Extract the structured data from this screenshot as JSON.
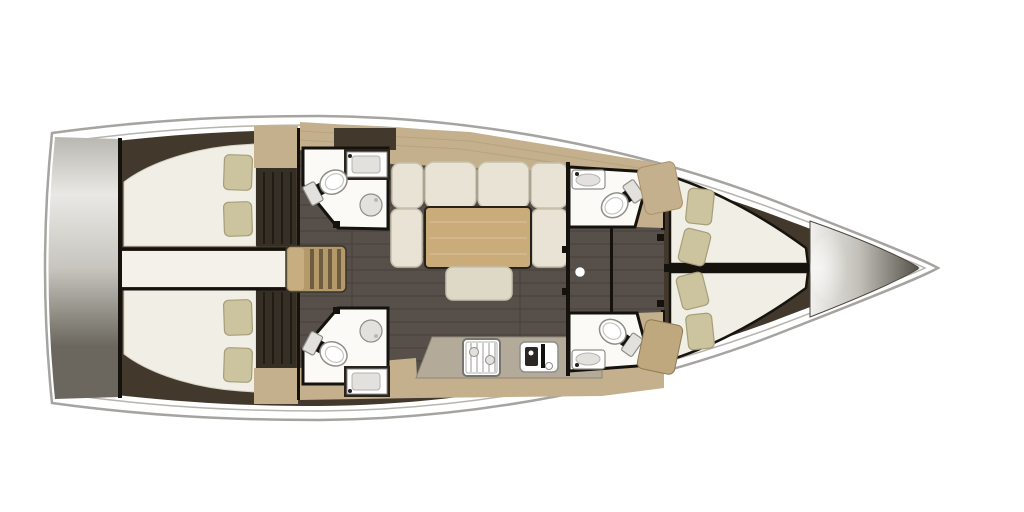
{
  "plan": {
    "description": "Sailing yacht interior floor plan, top-down view, bow to the right",
    "rooms": [
      {
        "id": "swim-platform",
        "type": "transom-platform",
        "fixtures": [
          "platform"
        ]
      },
      {
        "id": "aft-cabin-port",
        "type": "double-berth-cabin",
        "fixtures": [
          "double-berth",
          "pillow",
          "pillow",
          "wardrobe"
        ]
      },
      {
        "id": "aft-cabin-starboard",
        "type": "double-berth-cabin",
        "fixtures": [
          "double-berth",
          "pillow",
          "pillow",
          "wardrobe"
        ]
      },
      {
        "id": "engine-compartment",
        "type": "passage",
        "fixtures": []
      },
      {
        "id": "companionway",
        "type": "entry",
        "fixtures": [
          "steps"
        ]
      },
      {
        "id": "head-aft-port",
        "type": "bathroom",
        "fixtures": [
          "toilet",
          "sink",
          "shower"
        ]
      },
      {
        "id": "head-aft-starboard",
        "type": "bathroom",
        "fixtures": [
          "toilet",
          "sink",
          "shower"
        ]
      },
      {
        "id": "salon",
        "type": "saloon",
        "fixtures": [
          "u-shaped-settee",
          "table",
          "ottoman"
        ]
      },
      {
        "id": "galley",
        "type": "kitchen",
        "fixtures": [
          "stove",
          "double-sink",
          "counter"
        ]
      },
      {
        "id": "head-forward-port",
        "type": "bathroom",
        "fixtures": [
          "toilet",
          "sink"
        ]
      },
      {
        "id": "head-forward-starboard",
        "type": "bathroom",
        "fixtures": [
          "toilet",
          "sink"
        ]
      },
      {
        "id": "mast-post",
        "type": "structure",
        "fixtures": [
          "compression-post"
        ]
      },
      {
        "id": "forward-cabin-port",
        "type": "v-berth",
        "fixtures": [
          "berth",
          "pillow",
          "pillow"
        ]
      },
      {
        "id": "forward-cabin-starboard",
        "type": "v-berth",
        "fixtures": [
          "berth",
          "pillow",
          "pillow"
        ]
      },
      {
        "id": "bow-locker",
        "type": "anchor-locker",
        "fixtures": [
          "locker-cone"
        ]
      }
    ],
    "counts": {
      "cabins": 4,
      "heads": 4,
      "pillows": 8,
      "settee_back_cushions": 4,
      "companionway_steps": 4
    }
  },
  "colors": {
    "hull_fill": "#ffffff",
    "hull_outline": "#a6a4a0",
    "deck_line": "#b7b4ae",
    "interior_dark": "#42382c",
    "wood": "#c4b08c",
    "wood_grain": "#a8916a",
    "floor": "#57504a",
    "floor_line": "#3a352f",
    "wall": "#15120d",
    "room_white": "#fbfaf6",
    "fixture_line": "#8f8e89",
    "fixture_fill": "#ffffff",
    "fixture_gray": "#e2e1dd",
    "mattress": "#f1eee5",
    "pillow": "#cbc49f",
    "pillow_line": "#a59e79",
    "cushion": "#e8e3d4",
    "cushion_shade": "#c6c0ad",
    "table": "#c9ac7a",
    "table_line": "#262119",
    "ottoman": "#ded9c7",
    "counter": "#b3aa9a",
    "steps": "#b49a6b",
    "steps_cap": "#c6ae80",
    "steps_stripe": "#6e5c40",
    "wardrobe_dark": "#362f26",
    "passage_white": "#f3f1ea",
    "post": "#ffffff",
    "bench": "#bfa87e",
    "transom_top": "#b9b7b1",
    "transom_light": "#e9e8e4",
    "transom_mid": "#c7c5be",
    "transom_dark": "#6b675e",
    "cone_light": "#f2f1ed",
    "cone_mid": "#c2c0b9",
    "cone_dark": "#56534c"
  }
}
